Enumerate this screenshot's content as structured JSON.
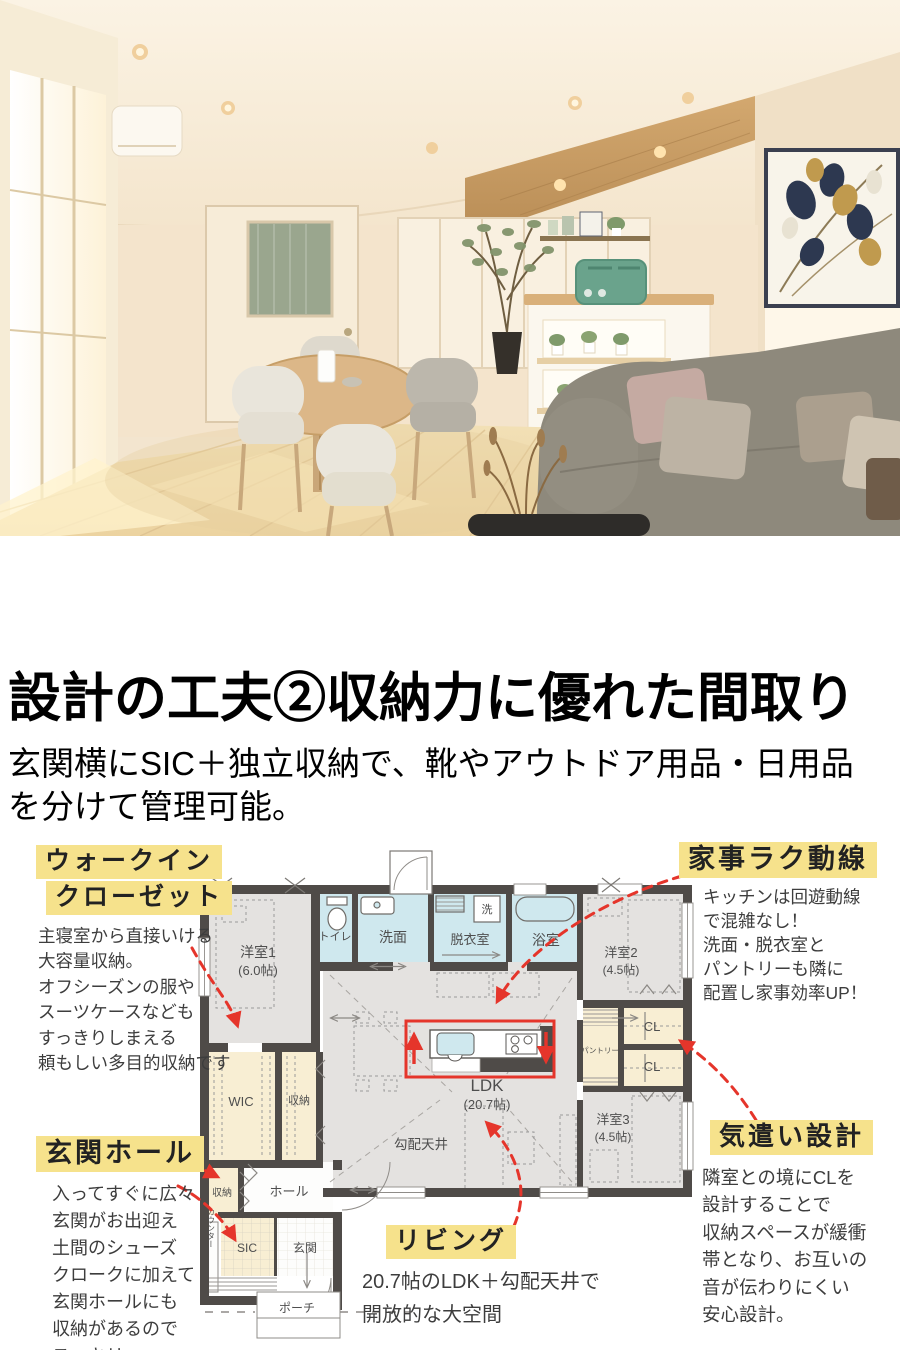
{
  "headline": {
    "title": "設計の工夫②収納力に優れた間取り",
    "subtitle_line1": "玄関横にSIC＋独立収納で、靴やアウトドア用品・日用品",
    "subtitle_line2": "を分けて管理可能。"
  },
  "colors": {
    "highlight_yellow": "#f6e28c",
    "arrow_red": "#e5352b",
    "wall_dark": "#4f4b48",
    "room_gray": "#e4e2e0",
    "wet_blue": "#cfe8ee",
    "storage_cream": "#f8eed3"
  },
  "floor_plan": {
    "labels": {
      "room1": "洋室1",
      "room1_size": "(6.0帖)",
      "toilet": "トイレ",
      "washroom": "洗面",
      "dressing": "脱衣室",
      "washer": "洗",
      "bath": "浴室",
      "room2": "洋室2",
      "room2_size": "(4.5帖)",
      "pantry": "パントリー",
      "cl_upper": "CL",
      "cl_lower": "CL",
      "ldk": "LDK",
      "ldk_size": "(20.7帖)",
      "sloped_ceiling": "勾配天井",
      "room3": "洋室3",
      "room3_size": "(4.5帖)",
      "wic": "WIC",
      "storage_mid": "収納",
      "storage_hall": "収納",
      "hall": "ホール",
      "counter": "カウンター",
      "sic": "SIC",
      "entrance": "玄関",
      "porch": "ポーチ"
    }
  },
  "annotations": {
    "wic": {
      "title_line1": "ウォークイン",
      "title_line2": "クローゼット",
      "body": [
        "主寝室から直接いける",
        "大容量収納。",
        "オフシーズンの服や",
        "スーツケースなども",
        "すっきりしまえる",
        "頼もしい多目的収納です"
      ]
    },
    "kaji": {
      "title": "家事ラク動線",
      "body": [
        "キッチンは回遊動線",
        "で混雑なし！",
        "洗面・脱衣室と",
        "パントリーも隣に",
        "配置し家事効率UP！"
      ]
    },
    "genkan": {
      "title": "玄関ホール",
      "body": [
        "入ってすぐに広々",
        "玄関がお出迎え",
        "土間のシューズ",
        "クロークに加えて",
        "玄関ホールにも",
        "収納があるので",
        "スッキリ"
      ]
    },
    "living": {
      "title": "リビング",
      "body": [
        "20.7帖のLDK＋勾配天井で",
        "開放的な大空間"
      ]
    },
    "kizukai": {
      "title": "気遣い設計",
      "body": [
        "隣室との境にCLを",
        "設計することで",
        "収納スペースが緩衝",
        "帯となり、お互いの",
        "音が伝わりにくい",
        "安心設計。"
      ]
    }
  }
}
